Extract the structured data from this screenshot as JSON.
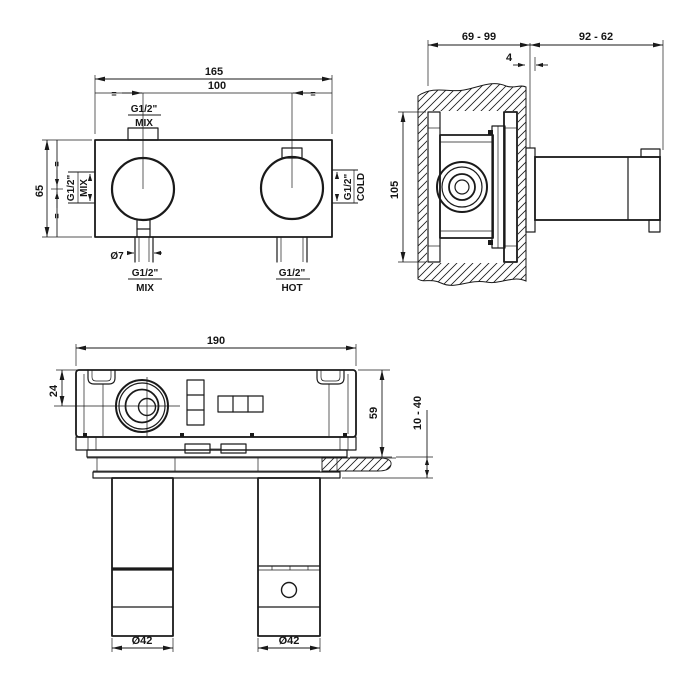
{
  "page": {
    "background": "#ffffff",
    "ink": "#1a1a1a"
  },
  "views": {
    "front": {
      "dim_width_overall": "165",
      "dim_port_spacing": "100",
      "dim_height": "65",
      "dim_pilot_hole": "Ø7",
      "eq": "=",
      "port_top": {
        "thread": "G1/2\"",
        "label": "MIX"
      },
      "port_left": {
        "thread": "G1/2\"",
        "label": "MIX"
      },
      "port_right": {
        "thread": "G1/2\"",
        "label": "COLD"
      },
      "port_bottom_left": {
        "thread": "G1/2\"",
        "label": "MIX"
      },
      "port_bottom_right": {
        "thread": "G1/2\"",
        "label": "HOT"
      }
    },
    "side": {
      "dim_recess_depth_range": "69 - 99",
      "dim_projection_range": "92 - 62",
      "dim_plate_thickness": "4",
      "dim_body_height": "105"
    },
    "plan": {
      "dim_width": "190",
      "dim_center_offset": "24",
      "dim_body_depth": "59",
      "dim_wall_thickness_range": "10 - 40",
      "dim_handle_left": "Ø42",
      "dim_handle_right": "Ø42"
    }
  }
}
